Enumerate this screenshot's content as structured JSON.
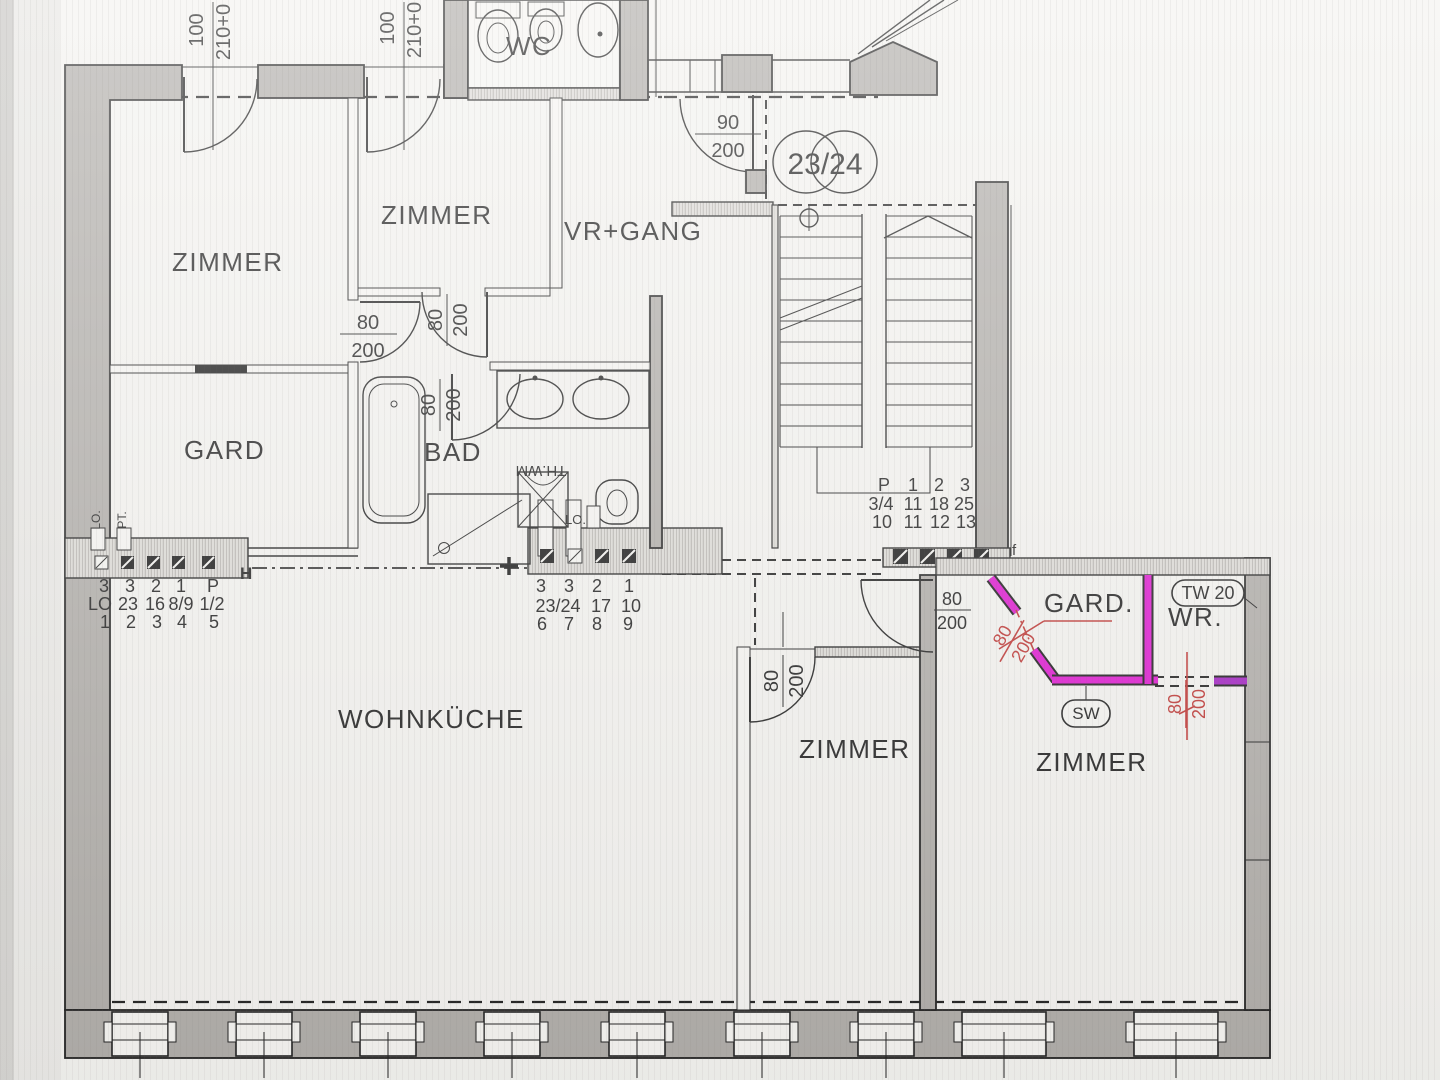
{
  "rooms": {
    "zimmer_left": "ZIMMER",
    "zimmer_top": "ZIMMER",
    "vr_gang": "VR+GANG",
    "gard_left": "GARD",
    "bad": "BAD",
    "wc": "WC",
    "wohnkueche": "WOHNKÜCHE",
    "zimmer_bottom_mid": "ZIMMER",
    "zimmer_right": "ZIMMER",
    "gard_right": "GARD.",
    "wr": "WR."
  },
  "badges": {
    "apartment_no": "23/24",
    "door_tag": "TW 20",
    "sw_tag": "SW"
  },
  "marks": {
    "h": "H",
    "f": "f",
    "lo_shaft": "LO.",
    "pt_shaft": "PT.",
    "lo_bad": "LO.",
    "th_wm": "TH.WM"
  },
  "doors": [
    {
      "id": "left-room-entry",
      "width": "100",
      "height": "210+0"
    },
    {
      "id": "middle-room-entry",
      "width": "100",
      "height": "210+0"
    },
    {
      "id": "apartment-entrance",
      "width": "90",
      "height": "200"
    },
    {
      "id": "gard-door",
      "width": "80",
      "height": "200"
    },
    {
      "id": "upper-room-door",
      "width": "80",
      "height": "200"
    },
    {
      "id": "bad-door",
      "width": "80",
      "height": "200"
    },
    {
      "id": "mid-room-door",
      "width": "80",
      "height": "200"
    },
    {
      "id": "right-apartment-entry",
      "width": "80",
      "height": "200"
    },
    {
      "id": "gard-right-door",
      "width": "80",
      "height": "200"
    },
    {
      "id": "wr-door",
      "width": "80",
      "height": "200"
    }
  ],
  "tables": {
    "left": {
      "rows": [
        [
          "3",
          "3",
          "2",
          "1",
          "P"
        ],
        [
          "LO",
          "23",
          "16",
          "8/9",
          "1/2"
        ],
        [
          "1",
          "2",
          "3",
          "4",
          "5"
        ]
      ]
    },
    "middle": {
      "rows": [
        [
          "3",
          "3",
          "2",
          "1"
        ],
        [
          "23/24",
          "17",
          "10"
        ],
        [
          "6",
          "7",
          "8",
          "9"
        ]
      ]
    },
    "stair": {
      "rows": [
        [
          "P",
          "1",
          "2",
          "3"
        ],
        [
          "3/4",
          "11",
          "18",
          "25"
        ],
        [
          "10",
          "11",
          "12",
          "13"
        ]
      ]
    }
  },
  "colors": {
    "paper": "#f4f3f0",
    "line": "#242424",
    "wall_fill": "#b2afab",
    "hatch_fill": "#dedcd8",
    "magenta": "#df1ed2",
    "purple": "#a427c4",
    "red_dim": "#c03a38"
  }
}
